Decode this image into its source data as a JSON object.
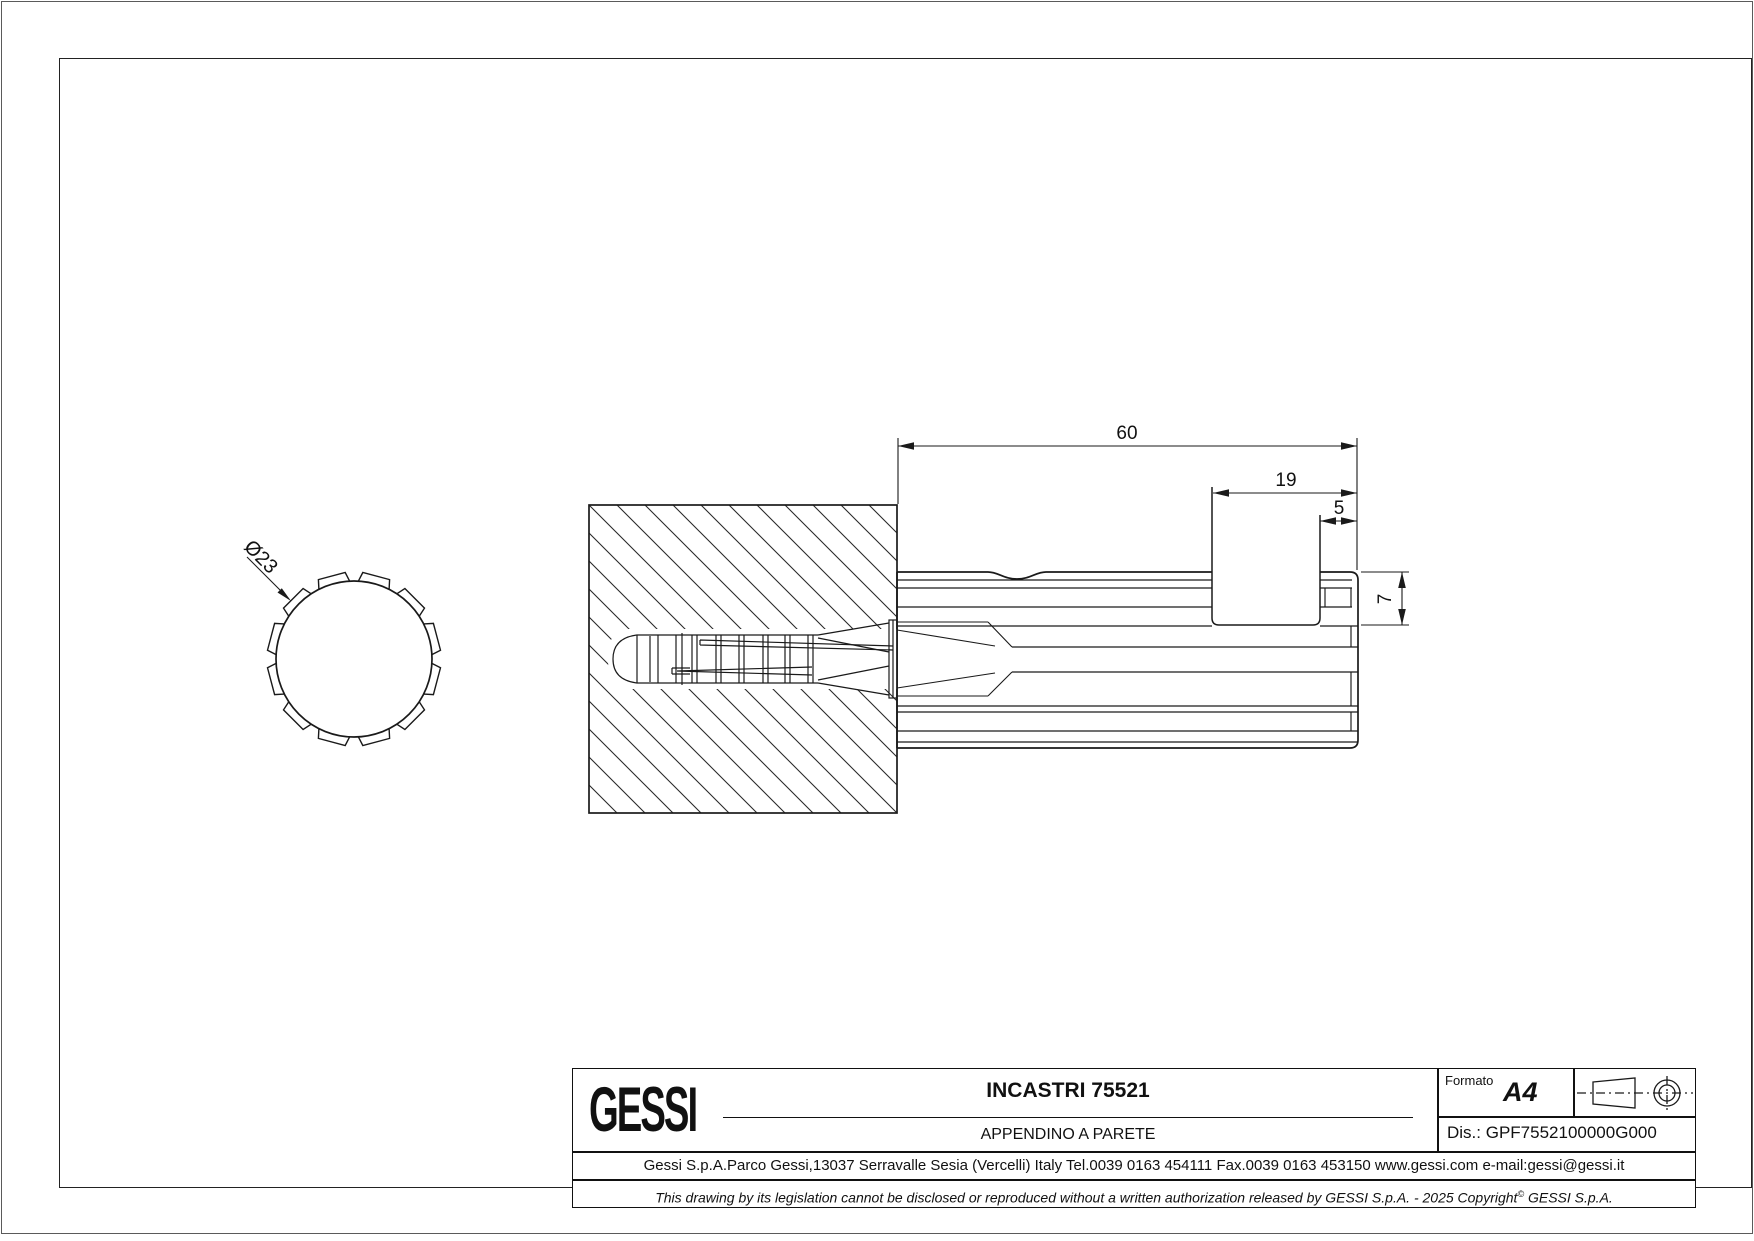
{
  "front_view": {
    "diameter_label": "Ø23"
  },
  "side_view": {
    "dim_total_length": "60",
    "dim_slot_to_end": "19",
    "dim_lip": "5",
    "dim_slot_depth": "7"
  },
  "title_block": {
    "logo": "GESSI",
    "title": "INCASTRI 75521",
    "subtitle": "APPENDINO A PARETE",
    "formato_label": "Formato",
    "formato_value": "A4",
    "drawing_number": "Dis.: GPF7552100000G000",
    "address": "Gessi S.p.A.Parco Gessi,13037 Serravalle Sesia (Vercelli) Italy Tel.0039 0163 454111 Fax.0039 0163 453150 www.gessi.com e-mail:gessi@gessi.it",
    "disclaimer_text": "This drawing by its legislation cannot be disclosed or reproduced without a written authorization released by GESSI S.p.A. - 2025 Copyright",
    "disclaimer_sup": "©",
    "disclaimer_suffix": " GESSI S.p.A."
  }
}
